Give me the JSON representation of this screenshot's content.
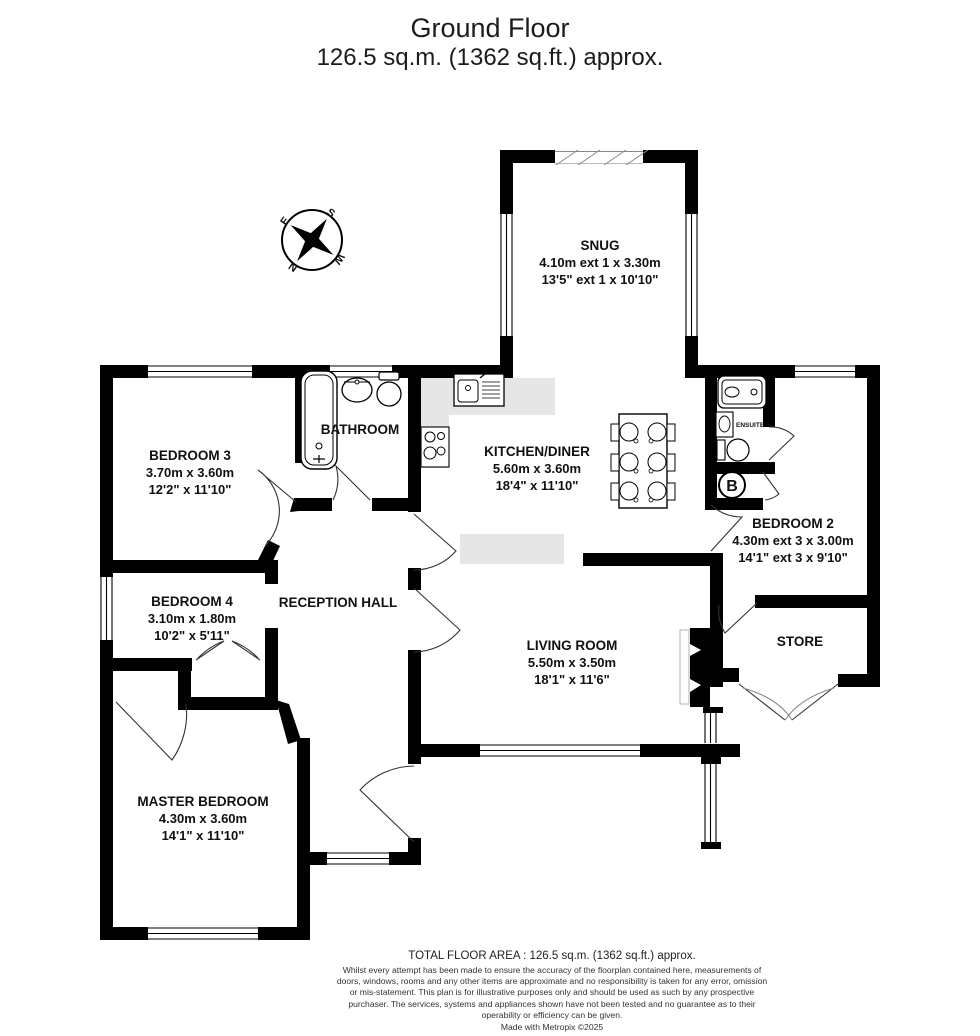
{
  "title": {
    "line1": "Ground Floor",
    "line2": "126.5 sq.m. (1362 sq.ft.) approx."
  },
  "compass": {
    "n": "N",
    "e": "E",
    "s": "S",
    "w": "W"
  },
  "rooms": {
    "snug": {
      "name": "SNUG",
      "metric": "4.10m ext 1 x 3.30m",
      "imperial": "13'5\" ext 1 x 10'10\""
    },
    "bedroom3": {
      "name": "BEDROOM 3",
      "metric": "3.70m  x 3.60m",
      "imperial": "12'2\"  x 11'10\""
    },
    "bathroom": {
      "name": "BATHROOM"
    },
    "kitchen": {
      "name": "KITCHEN/DINER",
      "metric": "5.60m  x 3.60m",
      "imperial": "18'4\"  x 11'10\""
    },
    "bedroom2": {
      "name": "BEDROOM 2",
      "metric": "4.30m ext 3 x 3.00m",
      "imperial": "14'1\" ext 3 x 9'10\""
    },
    "bedroom4": {
      "name": "BEDROOM 4",
      "metric": "3.10m  x 1.80m",
      "imperial": "10'2\"  x 5'11\""
    },
    "reception": {
      "name": "RECEPTION HALL"
    },
    "living": {
      "name": "LIVING ROOM",
      "metric": "5.50m  x 3.50m",
      "imperial": "18'1\"  x 11'6\""
    },
    "store": {
      "name": "STORE"
    },
    "master": {
      "name": "MASTER BEDROOM",
      "metric": "4.30m  x 3.60m",
      "imperial": "14'1\"  x 11'10\""
    },
    "ensuite": {
      "name": "ENSUITE"
    },
    "boiler": {
      "label": "B"
    }
  },
  "footer": {
    "total": "TOTAL FLOOR AREA : 126.5 sq.m. (1362 sq.ft.) approx.",
    "disclaimer": "Whilst every attempt has been made to ensure the accuracy of the floorplan contained here, measurements of doors, windows, rooms and any other items are approximate and no responsibility is taken for any error, omission or mis-statement. This plan is for illustrative purposes only and should be used as such by any prospective purchaser. The services, systems and appliances shown have not been tested and no guarantee as to their operability or efficiency can be given.",
    "credit": "Made with Metropix ©2025"
  },
  "colors": {
    "wall": "#000000",
    "counter": "#e6e6e6",
    "background": "#ffffff"
  }
}
